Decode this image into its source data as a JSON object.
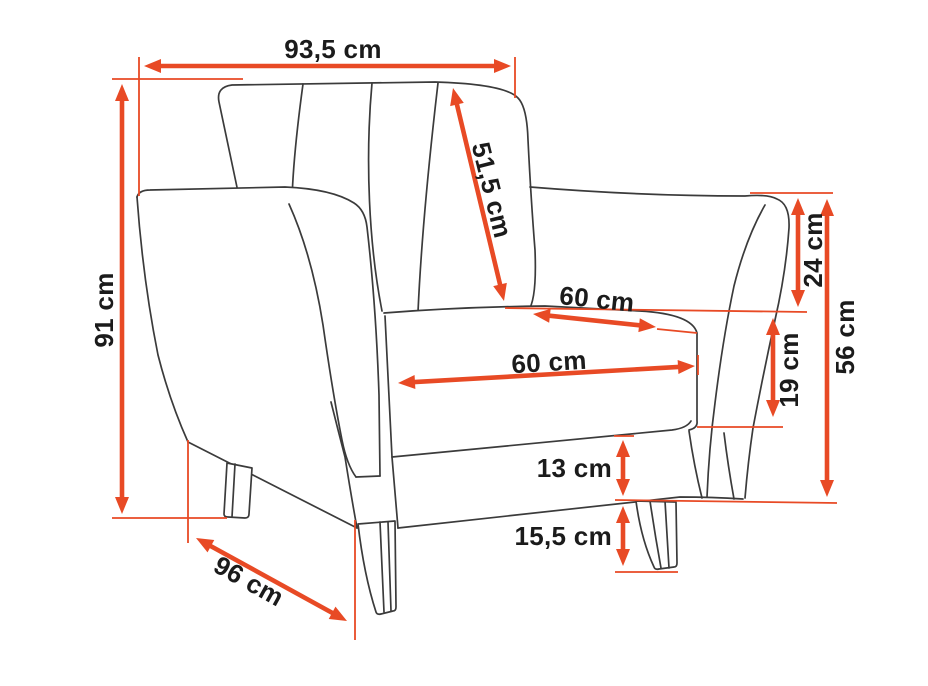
{
  "diagram": {
    "subject": "armchair dimension drawing",
    "unit": "cm",
    "colors": {
      "accent": "#e84a25",
      "outline": "#3b3b3b",
      "label": "#1b1b1b",
      "background": "#ffffff"
    },
    "dimensions": {
      "overall_width": {
        "label": "93,5 cm",
        "value": 93.5
      },
      "overall_height": {
        "label": "91 cm",
        "value": 91
      },
      "backrest_length": {
        "label": "51,5 cm",
        "value": 51.5
      },
      "seat_depth": {
        "label": "60 cm",
        "value": 60
      },
      "seat_width": {
        "label": "60 cm",
        "value": 60
      },
      "arm_to_seat": {
        "label": "24 cm",
        "value": 24
      },
      "arm_height": {
        "label": "56 cm",
        "value": 56
      },
      "seat_to_base": {
        "label": "19 cm",
        "value": 19
      },
      "base_height": {
        "label": "13 cm",
        "value": 13
      },
      "leg_height": {
        "label": "15,5 cm",
        "value": 15.5
      },
      "overall_depth": {
        "label": "96 cm",
        "value": 96
      }
    }
  }
}
